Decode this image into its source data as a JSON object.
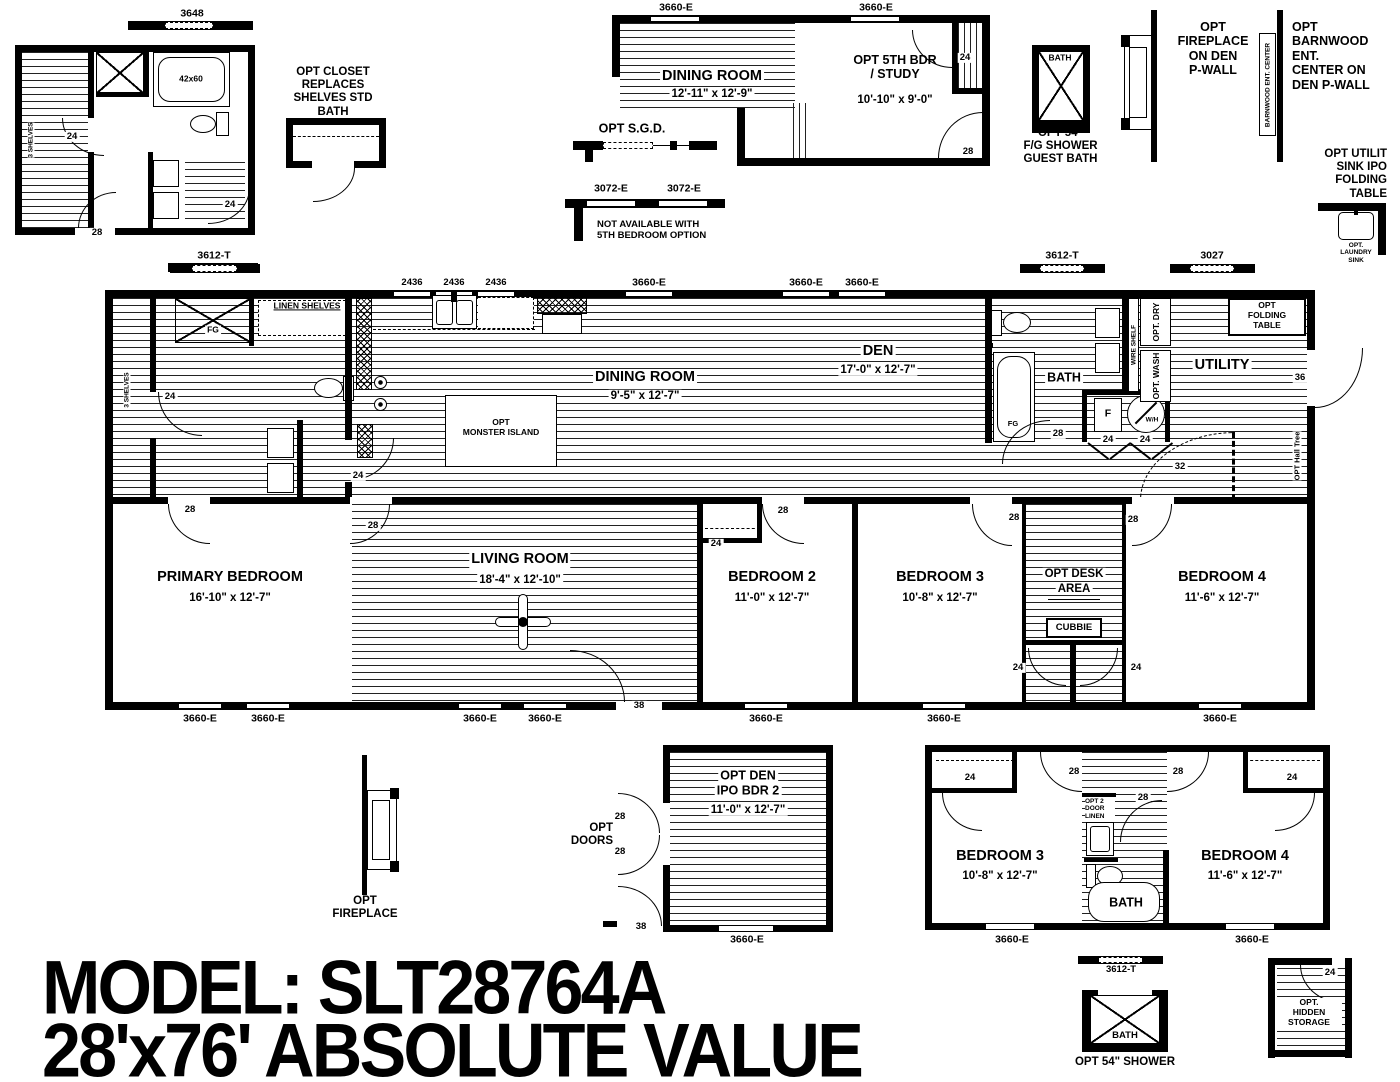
{
  "model": {
    "line1": "MODEL: SLT28764A",
    "line2": "28'x76' ABSOLUTE VALUE"
  },
  "bath_detail": {
    "win_top": "3648",
    "win_bottom": "3612-T",
    "shelves": "3 SHELVES",
    "tub": "42x60",
    "door_a": "24",
    "door_b": "24",
    "door_c": "28"
  },
  "opt_closet": {
    "lines": [
      "OPT  CLOSET",
      "REPLACES",
      "SHELVES STD",
      "BATH"
    ]
  },
  "opt_5th": {
    "win_a": "3660-E",
    "win_b": "3660-E",
    "dining": "DINING ROOM",
    "dining_dim": "12'-11\" x  12'-9\"",
    "name1": "OPT 5TH BDR",
    "name2": "/ STUDY",
    "dim": "10'-10\" x  9'-0\"",
    "closet": "24",
    "door": "28"
  },
  "opt_sgd": {
    "label": "OPT S.G.D."
  },
  "opt_3072": {
    "a": "3072-E",
    "b": "3072-E",
    "note1": "NOT  AVAILABLE  WITH",
    "note2": "5TH  BEDROOM  OPTION"
  },
  "opt_guest_shower": {
    "bath": "BATH",
    "cap": [
      "OPT 54\"",
      "F/G SHOWER",
      "GUEST BATH"
    ]
  },
  "opt_fireplace_den": {
    "lines": [
      "OPT",
      "FIREPLACE",
      "ON DEN",
      "P-WALL"
    ]
  },
  "opt_barnwood": {
    "vlabel": "BARNWOOD ENT. CENTER",
    "lines": [
      "OPT",
      "BARNWOOD",
      "ENT.",
      "CENTER ON",
      "DEN P-WALL"
    ]
  },
  "opt_utility_sink": {
    "lines": [
      "OPT UTILIT",
      "SINK IPO",
      "FOLDING",
      "TABLE"
    ],
    "sink": [
      "OPT.",
      "LAUNDRY",
      "SINK"
    ]
  },
  "main": {
    "top_dims": [
      "3612-T",
      "2436",
      "2436",
      "2436",
      "3660-E",
      "3660-E",
      "3660-E",
      "3612-T",
      "3027"
    ],
    "bottom_wins": [
      "3660-E",
      "3660-E",
      "3660-E",
      "3660-E",
      "3660-E",
      "3660-E",
      "3660-E"
    ],
    "left_bath": {
      "shelves": "3 SHELVES",
      "fg": "FG",
      "linen": "LINEN SHELVES",
      "door24": "24",
      "door24b": "24",
      "door28": "28"
    },
    "kitchen": {
      "dw": "D/W",
      "island1": "OPT",
      "island2": "MONSTER ISLAND"
    },
    "dining": {
      "name": "DINING ROOM",
      "dim": "9'-5\" x  12'-7\""
    },
    "den": {
      "name": "DEN",
      "dim": "17'-0\" x  12'-7\""
    },
    "bath2": {
      "name": "BATH",
      "fg": "FG",
      "door28": "28"
    },
    "utility": {
      "name": "UTILITY",
      "dry": "OPT. DRY",
      "wash": "OPT. WASH",
      "wire": "WIRE SHELF",
      "fold": [
        "OPT",
        "FOLDING",
        "TABLE"
      ],
      "f": "F",
      "wh": "W/H",
      "d24a": "24",
      "d24b": "24",
      "d32": "32",
      "d36": "36",
      "hall_tree": "OPT Hall Tree"
    },
    "primary": {
      "name": "PRIMARY BEDROOM",
      "dim": "16'-10\" x  12'-7\"",
      "door": "28"
    },
    "living": {
      "name": "LIVING ROOM",
      "dim": "18'-4\" x  12'-10\"",
      "door": "28",
      "door38": "38"
    },
    "bed2": {
      "name": "BEDROOM 2",
      "dim": "11'-0\" x  12'-7\"",
      "closet": "24",
      "door": "28"
    },
    "bed3": {
      "name": "BEDROOM 3",
      "dim": "10'-8\" x  12'-7\"",
      "door": "28"
    },
    "desk": {
      "l1": "OPT DESK",
      "l2": "AREA",
      "cubbie": "CUBBIE",
      "d24a": "24",
      "d24b": "24"
    },
    "bed4": {
      "name": "BEDROOM 4",
      "dim": "11'-6\" x  12'-7\"",
      "door": "28"
    }
  },
  "opt_fireplace2": {
    "lines": [
      "OPT",
      "FIREPLACE"
    ]
  },
  "opt_doors": {
    "l1": "OPT",
    "l2": "DOORS",
    "d28a": "28",
    "d28b": "28",
    "d38": "38"
  },
  "opt_den": {
    "l1": "OPT  DEN",
    "l2": "IPO BDR 2",
    "dim": "11'-0\" x  12'-7\"",
    "win": "3660-E"
  },
  "opt_beds": {
    "bed3": "BEDROOM 3",
    "bed3_dim": "10'-8\" x  12'-7\"",
    "bed4": "BEDROOM 4",
    "bed4_dim": "11'-6\" x  12'-7\"",
    "bath": "BATH",
    "linen": [
      "OPT 2",
      "DOOR",
      "LINEN"
    ],
    "c24a": "24",
    "c24b": "24",
    "d28a": "28",
    "d28b": "28",
    "d28c": "28",
    "win_a": "3660-E",
    "win_b": "3660-E",
    "win_c": "3612-T"
  },
  "opt_shower54": {
    "bath": "BATH",
    "cap": "OPT 54\" SHOWER"
  },
  "opt_hidden": {
    "d24": "24",
    "lines": [
      "OPT.",
      "HIDDEN",
      "STORAGE"
    ]
  }
}
